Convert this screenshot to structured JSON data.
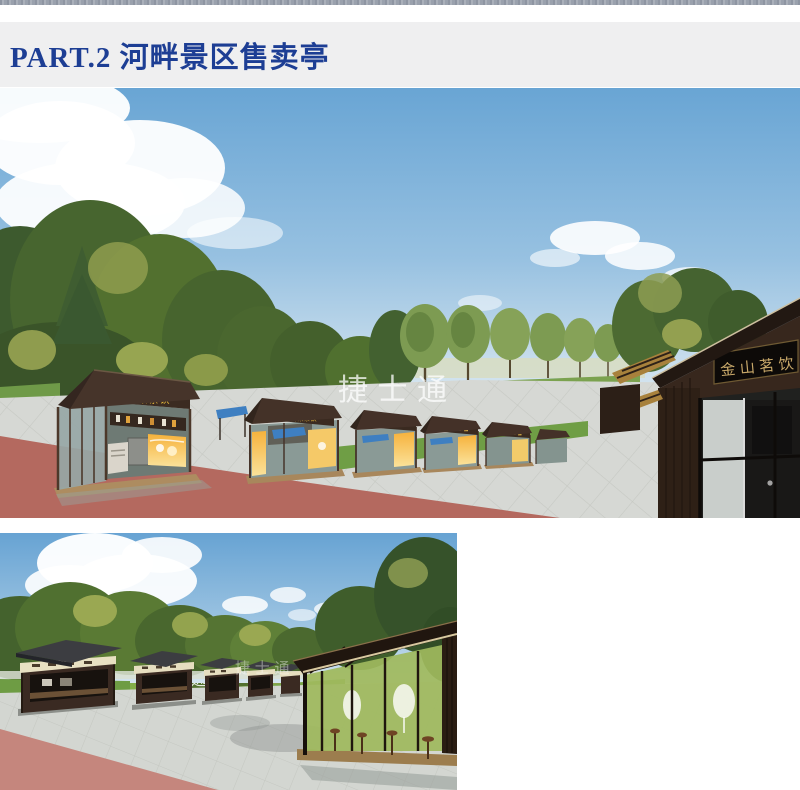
{
  "header": {
    "title": "PART.2 河畔景区售卖亭",
    "text_color": "#1d3e94",
    "background": "#efeff0"
  },
  "renders": {
    "main": {
      "kiosk_sign": "鲜果茶饮",
      "teahouse_sign": "金山茗饮",
      "watermark": "捷 士 通"
    },
    "aerial": {
      "watermark": "捷 士 通"
    },
    "street": {
      "watermark": "捷 士 通"
    }
  },
  "colors": {
    "header_blue": "#1d3e94",
    "sky_blue": "#6fa9d5",
    "paving_gray": "#d4d7d2",
    "path_pink": "#b4695f",
    "lawn_green": "#78a54a",
    "kiosk_wood_brown": "#42302a",
    "sign_yellow": "#f2c03c",
    "sign_gold": "#c9a96a",
    "awning_blue": "#3e7fc1"
  }
}
